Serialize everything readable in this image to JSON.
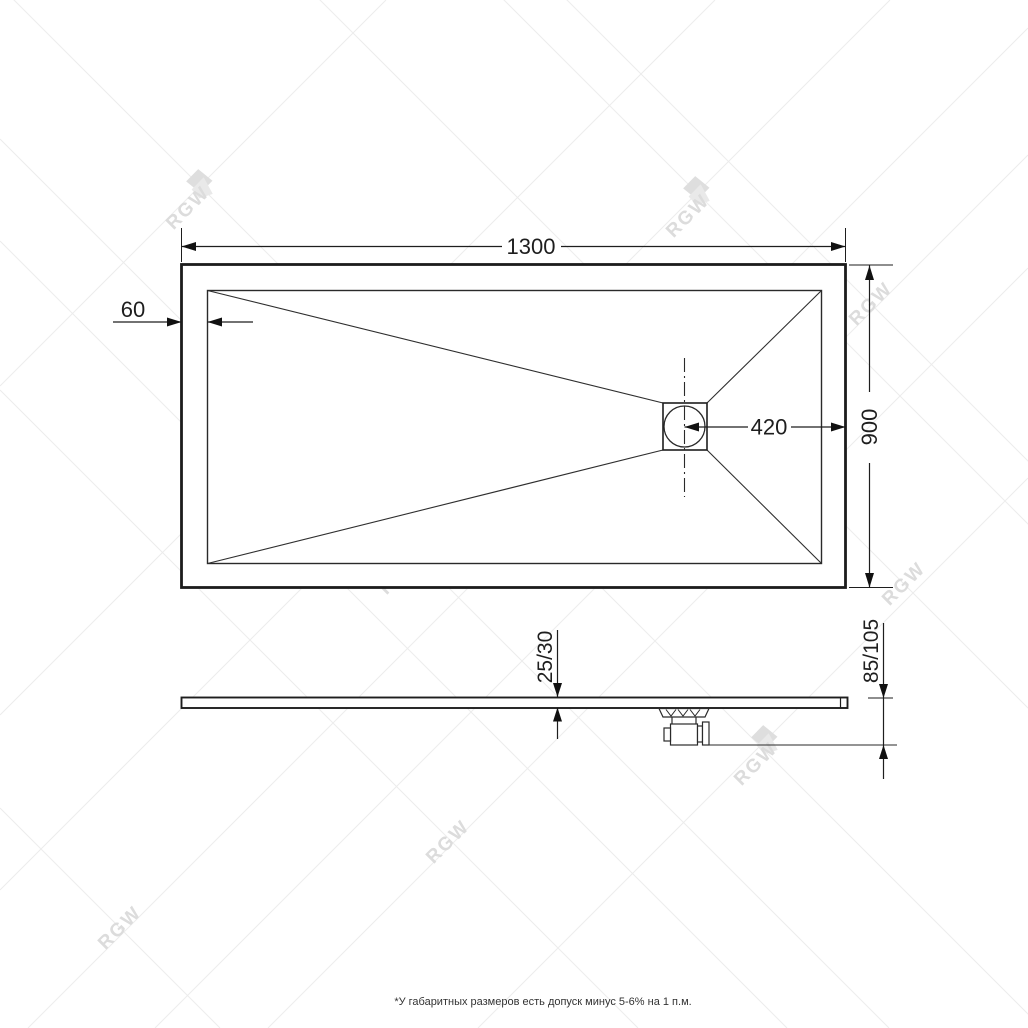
{
  "top_view": {
    "width_label": "1300",
    "height_label": "900",
    "rim_offset_label": "60",
    "drain_to_edge_label": "420"
  },
  "side_view": {
    "edge_thickness_label": "25/30",
    "overall_height_label": "85/105"
  },
  "watermark": {
    "brand": "RGW"
  },
  "footer": {
    "note": "*У габаритных размеров есть допуск минус  5-6% на 1 п.м."
  },
  "colors": {
    "line": "#1e1e1e",
    "watermark_text": "#dcdcdc",
    "background": "#ffffff"
  }
}
